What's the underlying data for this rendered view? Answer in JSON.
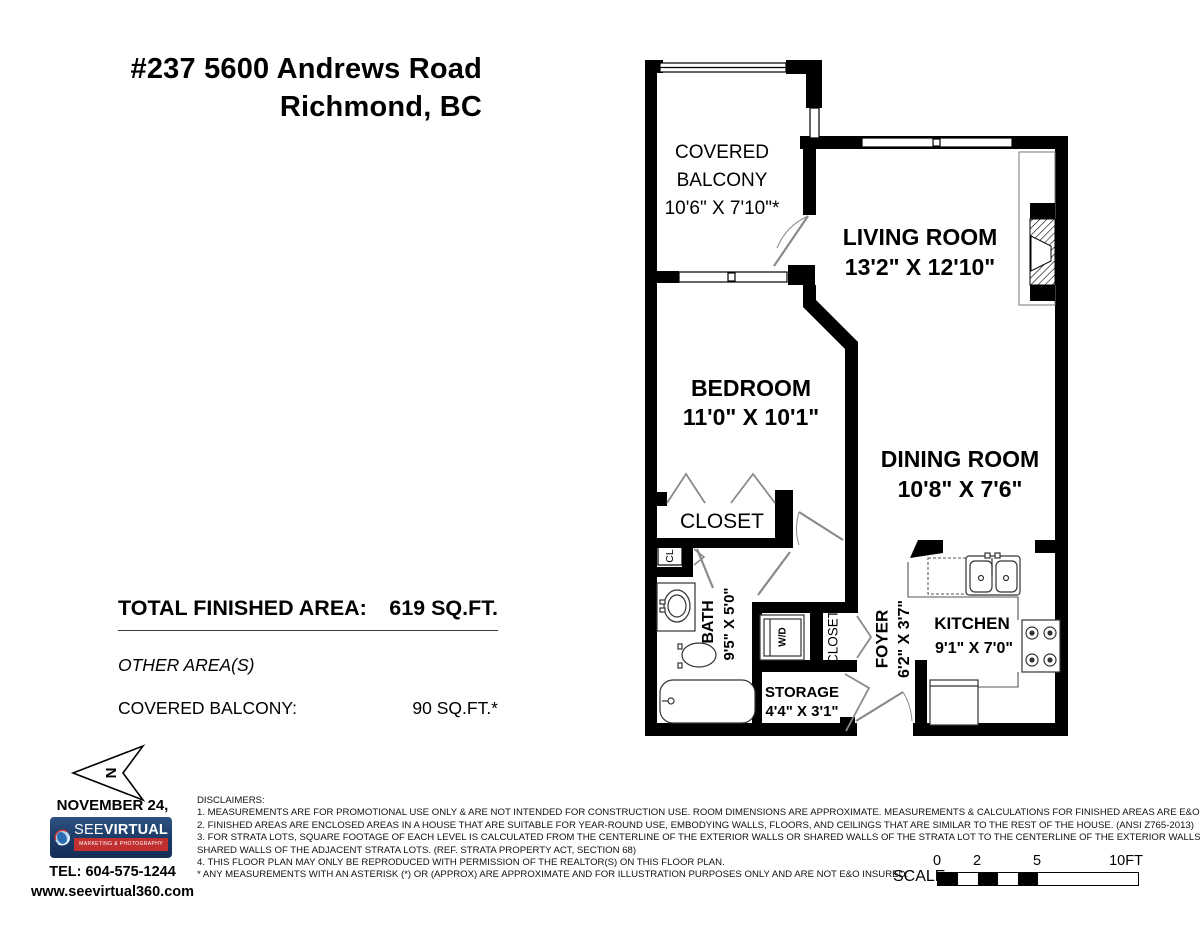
{
  "header": {
    "address_line1": "#237 5600 Andrews Road",
    "address_line2": "Richmond, BC"
  },
  "plan": {
    "rooms": {
      "balcony": {
        "name_line1": "COVERED",
        "name_line2": "BALCONY",
        "dims": "10'6\" X 7'10\"*"
      },
      "living": {
        "name": "LIVING ROOM",
        "dims": "13'2\" X 12'10\""
      },
      "bedroom": {
        "name": "BEDROOM",
        "dims": "11'0\" X 10'1\""
      },
      "dining": {
        "name": "DINING ROOM",
        "dims": "10'8\" X 7'6\""
      },
      "kitchen": {
        "name": "KITCHEN",
        "dims": "9'1\" X 7'0\""
      },
      "bath": {
        "name": "BATH",
        "dims": "9'5\" X 5'0\""
      },
      "foyer": {
        "name": "FOYER",
        "dims": "6'2\" X 3'7\""
      },
      "storage": {
        "name": "STORAGE",
        "dims": "4'4\" X 3'1\""
      },
      "closet": {
        "name": "CLOSET"
      },
      "hall_closet": {
        "name": "CLOSET"
      },
      "cl": {
        "name": "CL"
      },
      "wd": {
        "name": "W/D"
      }
    }
  },
  "areas": {
    "total_label": "TOTAL FINISHED AREA:",
    "total_value": "619 SQ.FT.",
    "other_heading": "OTHER AREA(S)",
    "balcony_label": "COVERED BALCONY:",
    "balcony_value": "90 SQ.FT.*"
  },
  "footer": {
    "north_label": "N",
    "date": "NOVEMBER 24, 2025",
    "logo_brand_light": "SEE",
    "logo_brand_bold": "VIRTUAL",
    "logo_tagline": "MARKETING & PHOTOGRAPHY",
    "tel": "TEL: 604-575-1244",
    "website": "www.seevirtual360.com"
  },
  "disclaimers": {
    "heading": "DISCLAIMERS:",
    "lines": [
      "1. MEASUREMENTS ARE FOR PROMOTIONAL USE ONLY & ARE NOT INTENDED FOR CONSTRUCTION USE. ROOM DIMENSIONS ARE APPROXIMATE. MEASUREMENTS & CALCULATIONS FOR FINISHED AREAS ARE E&O INSURED.",
      "2. FINISHED AREAS ARE ENCLOSED AREAS IN A HOUSE THAT ARE SUITABLE FOR YEAR-ROUND USE, EMBODYING WALLS, FLOORS, AND CEILINGS THAT ARE SIMILAR TO THE REST OF THE HOUSE. (ANSI Z765-2013)",
      "3. FOR STRATA LOTS, SQUARE FOOTAGE OF EACH LEVEL IS CALCULATED FROM THE CENTERLINE OF THE EXTERIOR WALLS OR SHARED WALLS OF THE STRATA LOT TO THE CENTERLINE OF THE EXTERIOR WALLS OR",
      "SHARED WALLS OF THE ADJACENT STRATA LOTS. (REF. STRATA PROPERTY ACT, SECTION 68)",
      "4. THIS FLOOR PLAN MAY ONLY BE REPRODUCED WITH PERMISSION OF THE REALTOR(S) ON THIS FLOOR PLAN.",
      "* ANY MEASUREMENTS WITH AN ASTERISK (*) OR (APPROX) ARE APPROXIMATE AND FOR ILLUSTRATION PURPOSES ONLY AND ARE NOT E&O INSURED."
    ]
  },
  "scale": {
    "label": "SCALE",
    "ticks": [
      "0",
      "2",
      "5",
      "10FT"
    ]
  },
  "colors": {
    "wall": "#000000",
    "door": "#8a8a8a",
    "logo_blue": "#1b3a66",
    "logo_red": "#c03030"
  }
}
